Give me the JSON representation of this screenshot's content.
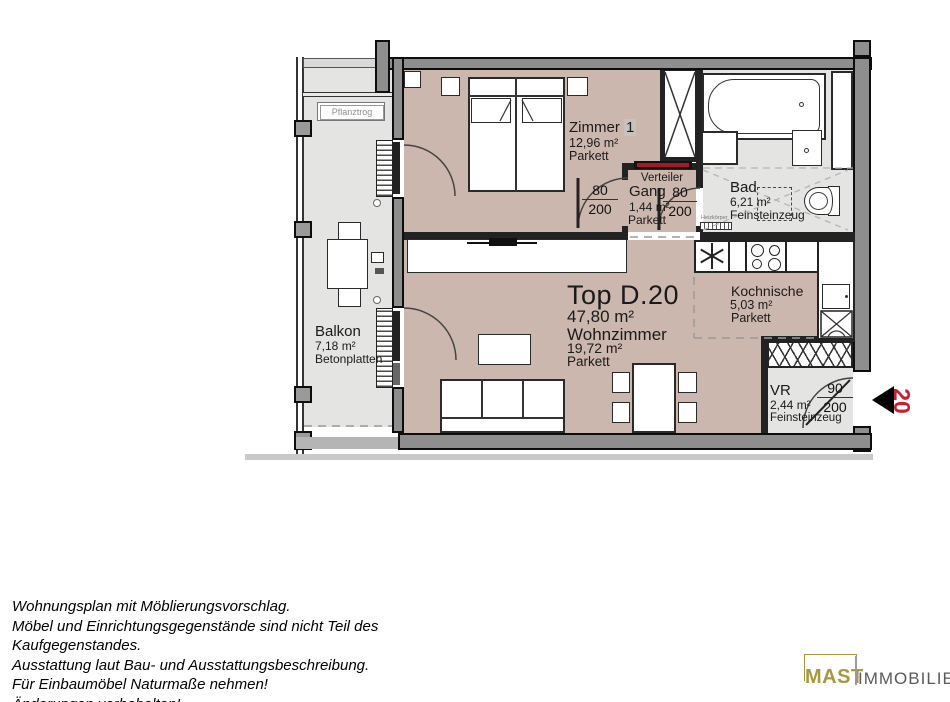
{
  "unit": {
    "title": "Top D.20",
    "area": "47,80 m²"
  },
  "rooms": {
    "zimmer1": {
      "name": "Zimmer",
      "number": "1",
      "area": "12,96 m²",
      "floor": "Parkett"
    },
    "gang": {
      "name": "Gang",
      "area": "1,44 m²",
      "floor": "Parkett"
    },
    "bad": {
      "name": "Bad",
      "area": "6,21 m²",
      "floor": "Feinsteinzeug"
    },
    "kochnische": {
      "name": "Kochnische",
      "area": "5,03 m²",
      "floor": "Parkett"
    },
    "wohnzimmer": {
      "name": "Wohnzimmer",
      "area": "19,72 m²",
      "floor": "Parkett"
    },
    "vr": {
      "name": "VR",
      "area": "2,44 m²",
      "floor": "Feinsteinzeug"
    },
    "balkon": {
      "name": "Balkon",
      "area": "7,18 m²",
      "floor": "Betonplatten"
    }
  },
  "labels": {
    "verteiler": "Verteiler",
    "pflanztrog": "Pflanztrog",
    "heizkoerper": "Heizkörper"
  },
  "doors": {
    "zimmer1": {
      "width": "80",
      "height": "200"
    },
    "bad": {
      "width": "80",
      "height": "200"
    },
    "entrance": {
      "width": "90",
      "height": "200"
    }
  },
  "entrance": {
    "unit_number": "20"
  },
  "disclaimer": {
    "lines": [
      "Wohnungsplan mit Möblierungsvorschlag.",
      "Möbel und Einrichtungsgegenstände sind nicht Teil des",
      "Kaufgegenstandes.",
      "Ausstattung laut Bau- und Ausstattungsbeschreibung.",
      "Für Einbaumöbel Naturmaße nehmen!",
      "Änderungen vorbehalten!"
    ]
  },
  "logo": {
    "name": "MAST",
    "suffix": "IMMOBILIEN"
  },
  "colors": {
    "floor_rose": "#ccb7ae",
    "floor_gray": "#e4e4e2",
    "accent_red": "#c5202c",
    "logo_gold": "#a6983f"
  }
}
